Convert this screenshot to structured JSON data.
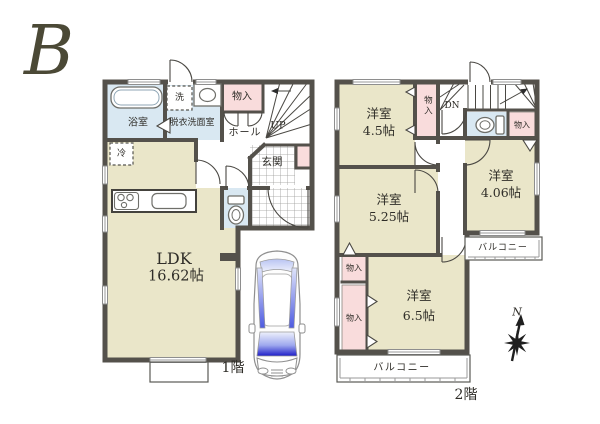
{
  "title_letter": "B",
  "floor1": {
    "label": "1階",
    "ldk": {
      "name": "LDK",
      "size": "16.62帖"
    },
    "bath": "浴室",
    "washroom": "脱衣洗面室",
    "washer": "洗",
    "fridge": "冷",
    "storage": "物入",
    "hall": "ホール",
    "stairs_up": "UP",
    "entrance": "玄関"
  },
  "floor2": {
    "label": "2階",
    "stairs_down": "DN",
    "rooms": {
      "room_45": {
        "name": "洋室",
        "size": "4.5帖"
      },
      "room_525": {
        "name": "洋室",
        "size": "5.25帖"
      },
      "room_406": {
        "name": "洋室",
        "size": "4.06帖"
      },
      "room_65": {
        "name": "洋室",
        "size": "6.5帖"
      }
    },
    "closets": {
      "tall": "物入",
      "right": "物入",
      "left_upper": "物入",
      "left_lower": "物入"
    },
    "balcony_right": "バルコニー",
    "balcony_bottom": "バルコニー"
  },
  "compass": {
    "north": "N"
  },
  "colors": {
    "wall": "#54514b",
    "room_beige": "#eae6c9",
    "water_blue": "#d9e8f2",
    "closet_pink": "#f9dcdc",
    "letter": "#4b4936",
    "text": "#2f2d28"
  }
}
